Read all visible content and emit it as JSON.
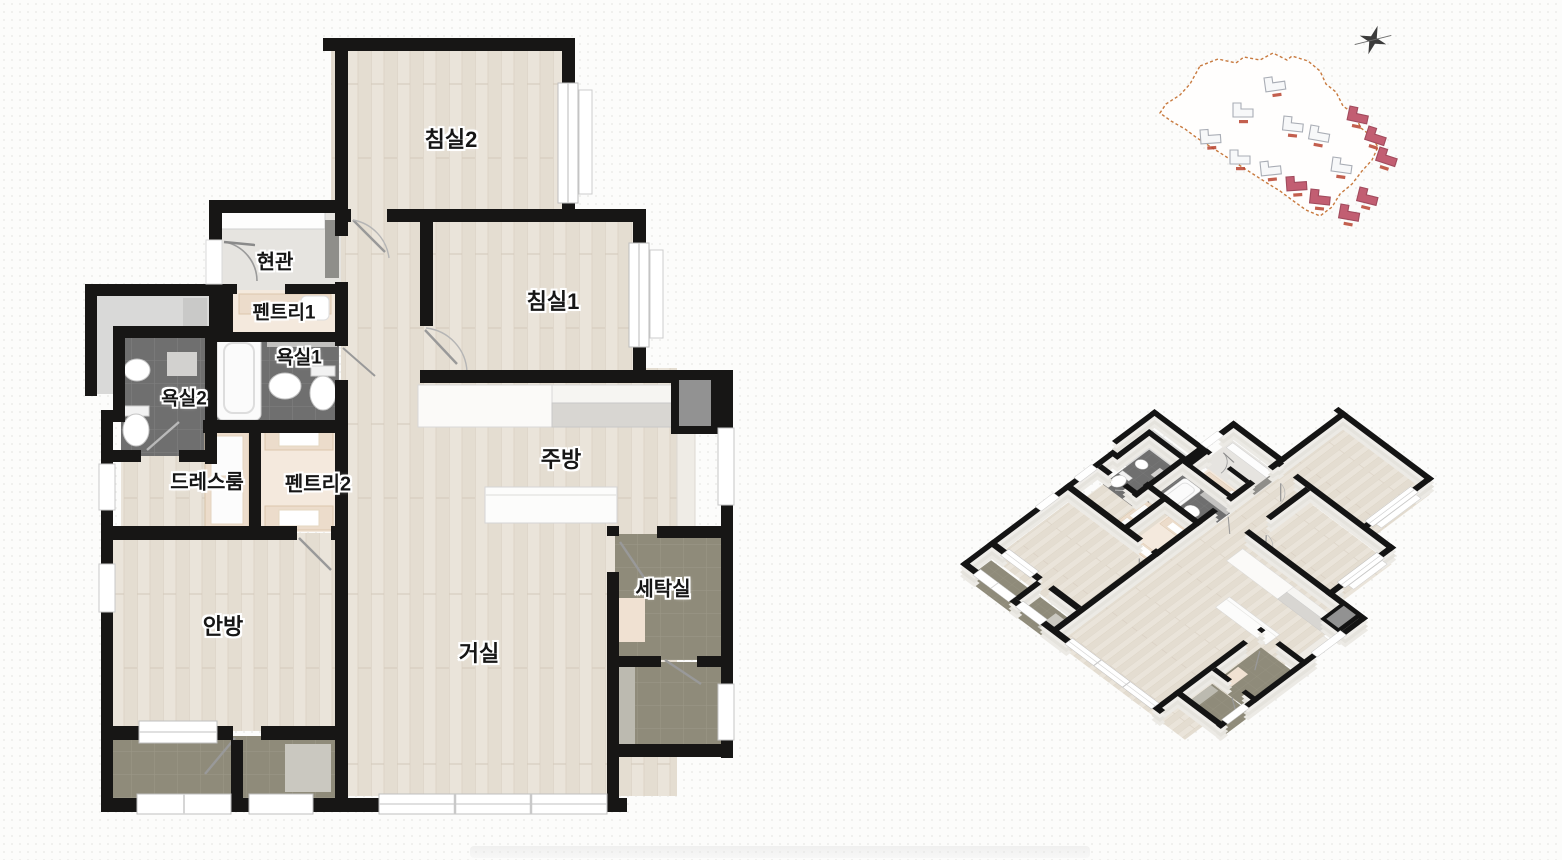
{
  "floor_plan": {
    "rooms": [
      {
        "id": "bedroom2",
        "label": "침실2"
      },
      {
        "id": "bedroom1",
        "label": "침실1"
      },
      {
        "id": "entrance",
        "label": "현관"
      },
      {
        "id": "pantry1",
        "label": "펜트리1"
      },
      {
        "id": "bath1",
        "label": "욕실1"
      },
      {
        "id": "bath2",
        "label": "욕실2"
      },
      {
        "id": "dressroom",
        "label": "드레스룸"
      },
      {
        "id": "pantry2",
        "label": "펜트리2"
      },
      {
        "id": "kitchen",
        "label": "주방"
      },
      {
        "id": "laundry",
        "label": "세탁실"
      },
      {
        "id": "master",
        "label": "안방"
      },
      {
        "id": "living",
        "label": "거실"
      }
    ],
    "colors": {
      "wall": "#171615",
      "wood_floor": "#eae4da",
      "bath_tile": "#6f6f6f",
      "balcony_tile": "#8f8b7a",
      "pantry_floor": "#f4e9dd",
      "cabinet": "#ecdccb",
      "entry_floor": "#e6e4e0",
      "public_hall": "#d9d9d8",
      "fixture_white": "#ffffff",
      "counter_gray": "#d8d6d2"
    }
  },
  "site_map": {
    "boundary_color": "#c87a3f",
    "building_stroke": "#a9adb5",
    "building_fill": "#f7f8f9",
    "highlight_fill": "#c25e72",
    "marker_color": "#b8432f",
    "north_icon": "compass-star",
    "buildings": [
      {
        "x": 124,
        "y": 64,
        "rot": -8,
        "hl": false
      },
      {
        "x": 93,
        "y": 89,
        "rot": 0,
        "hl": false
      },
      {
        "x": 144,
        "y": 102,
        "rot": 6,
        "hl": false
      },
      {
        "x": 60,
        "y": 116,
        "rot": -4,
        "hl": false
      },
      {
        "x": 171,
        "y": 111,
        "rot": 10,
        "hl": false
      },
      {
        "x": 90,
        "y": 136,
        "rot": 0,
        "hl": false
      },
      {
        "x": 120,
        "y": 148,
        "rot": -6,
        "hl": false
      },
      {
        "x": 193,
        "y": 143,
        "rot": 8,
        "hl": false
      },
      {
        "x": 210,
        "y": 92,
        "rot": 12,
        "hl": true
      },
      {
        "x": 229,
        "y": 112,
        "rot": 18,
        "hl": true
      },
      {
        "x": 240,
        "y": 133,
        "rot": 18,
        "hl": true
      },
      {
        "x": 146,
        "y": 163,
        "rot": -4,
        "hl": true
      },
      {
        "x": 171,
        "y": 175,
        "rot": 6,
        "hl": true
      },
      {
        "x": 201,
        "y": 190,
        "rot": 10,
        "hl": true
      },
      {
        "x": 220,
        "y": 173,
        "rot": 14,
        "hl": true
      }
    ]
  },
  "iso_view": {
    "wall_top_color": "#141414",
    "wall_side_color": "#eceae5"
  }
}
